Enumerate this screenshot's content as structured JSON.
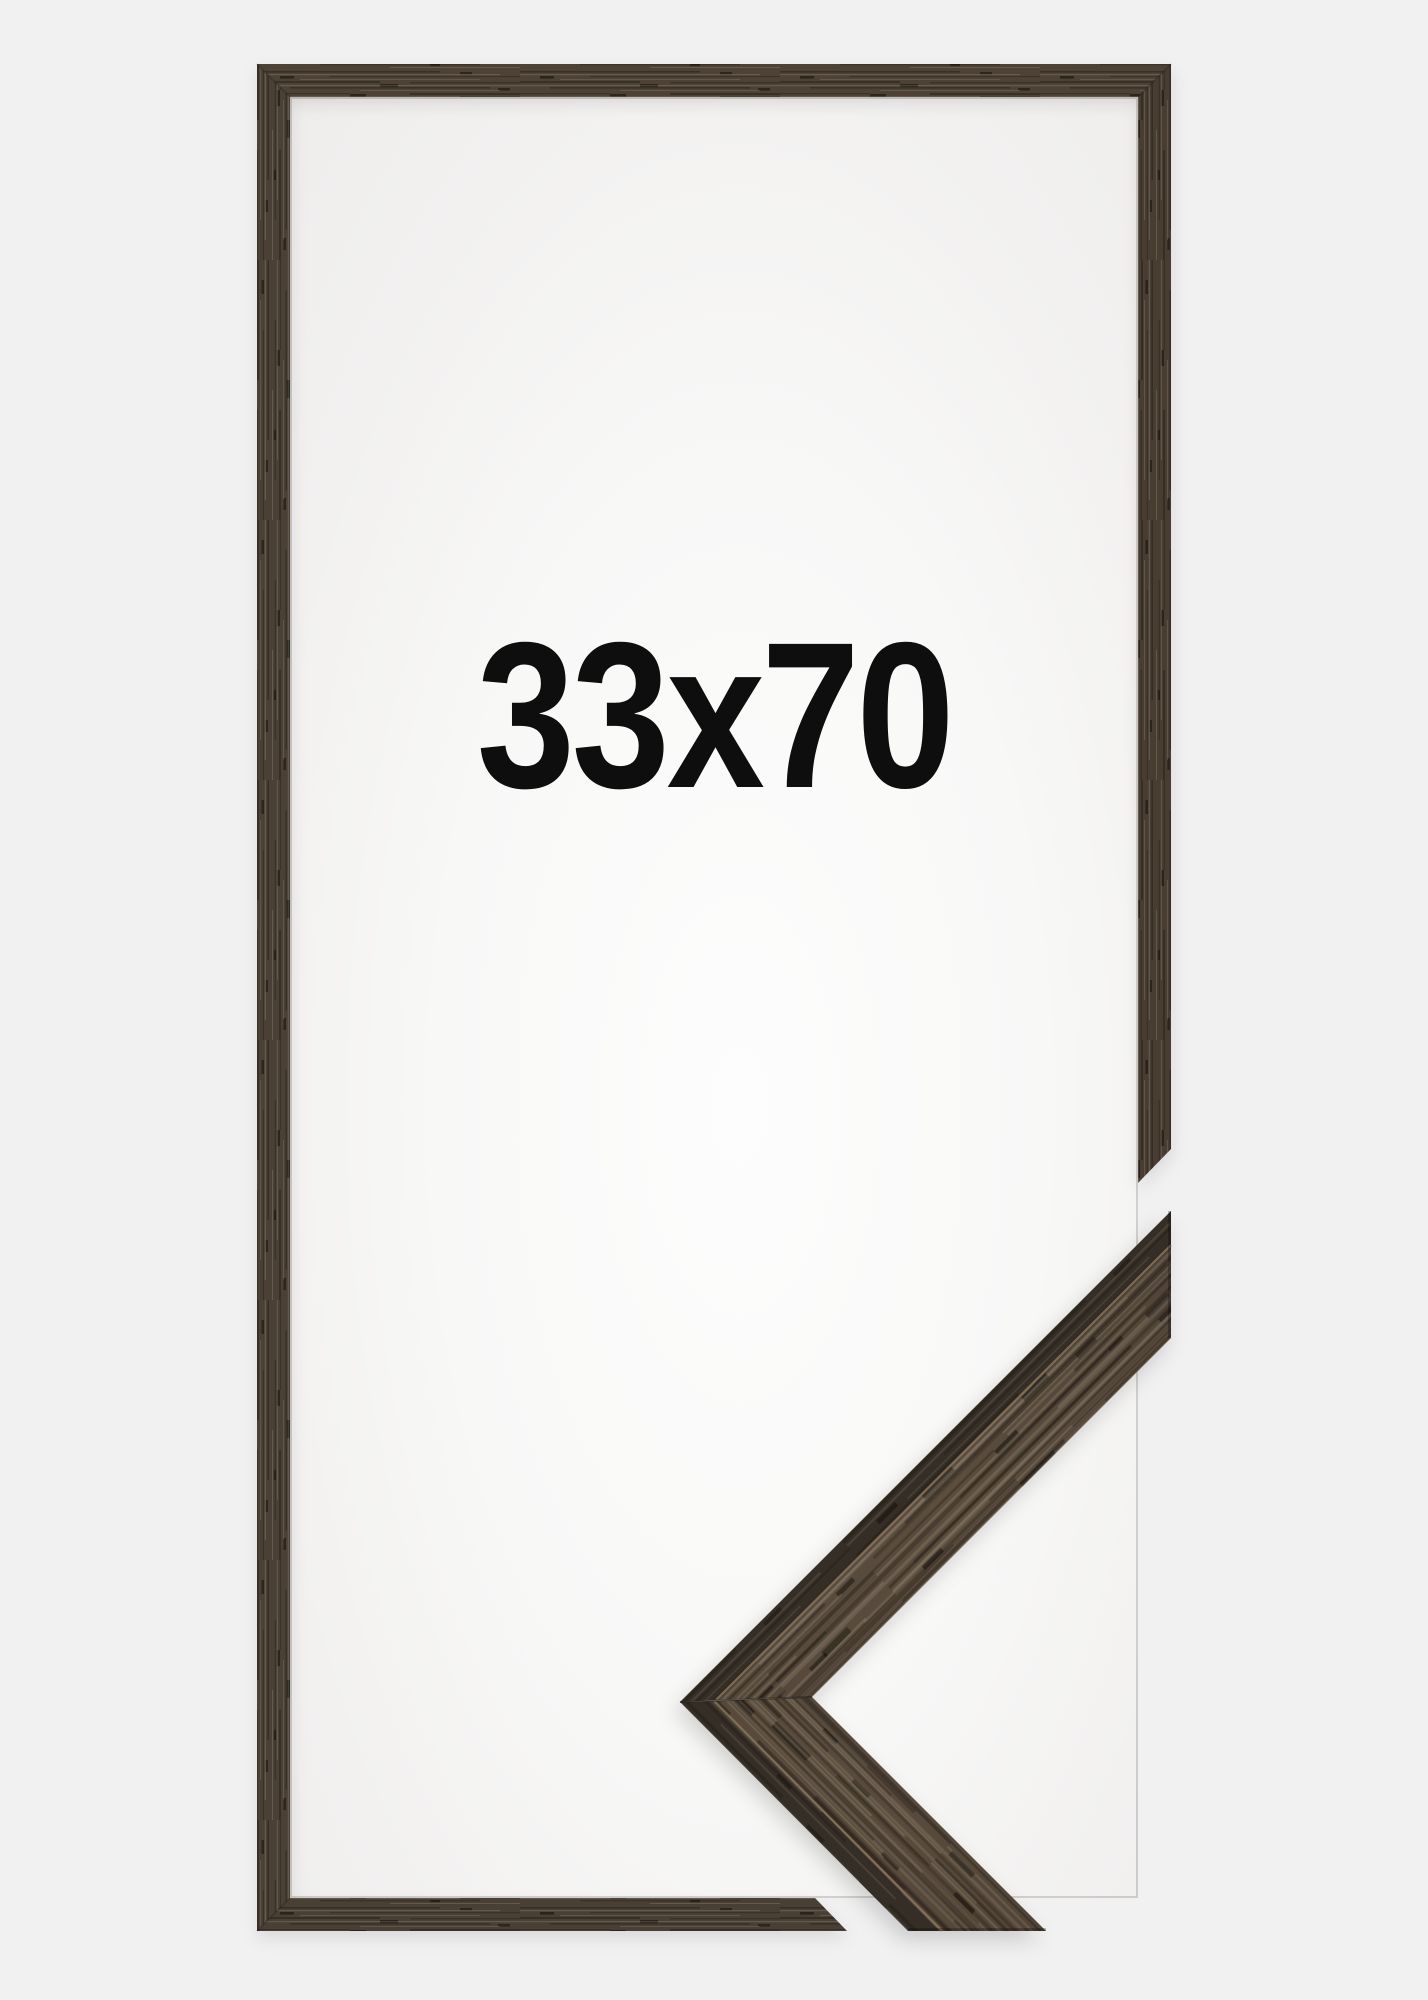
{
  "page": {
    "background_color": "#f1f1f2"
  },
  "frame_preview": {
    "size_label": "33x70",
    "label_color": "#0e0e0e",
    "wood": {
      "top_bar": "#4d4236",
      "left_bar": "#4b4135",
      "right_bar": "#483e33",
      "bottom_bar": "#4a4034"
    },
    "opening": {
      "paper_center": "#fdfdfd",
      "paper_edge": "#eeedec"
    },
    "corner_sample": {
      "upper_arm_top_face": "#5b4d3e",
      "lower_arm_top_face": "#594b3c",
      "front_face": "#352d25",
      "edge_highlight": "#8e7a5f",
      "miter_seam": "#241e18"
    }
  }
}
